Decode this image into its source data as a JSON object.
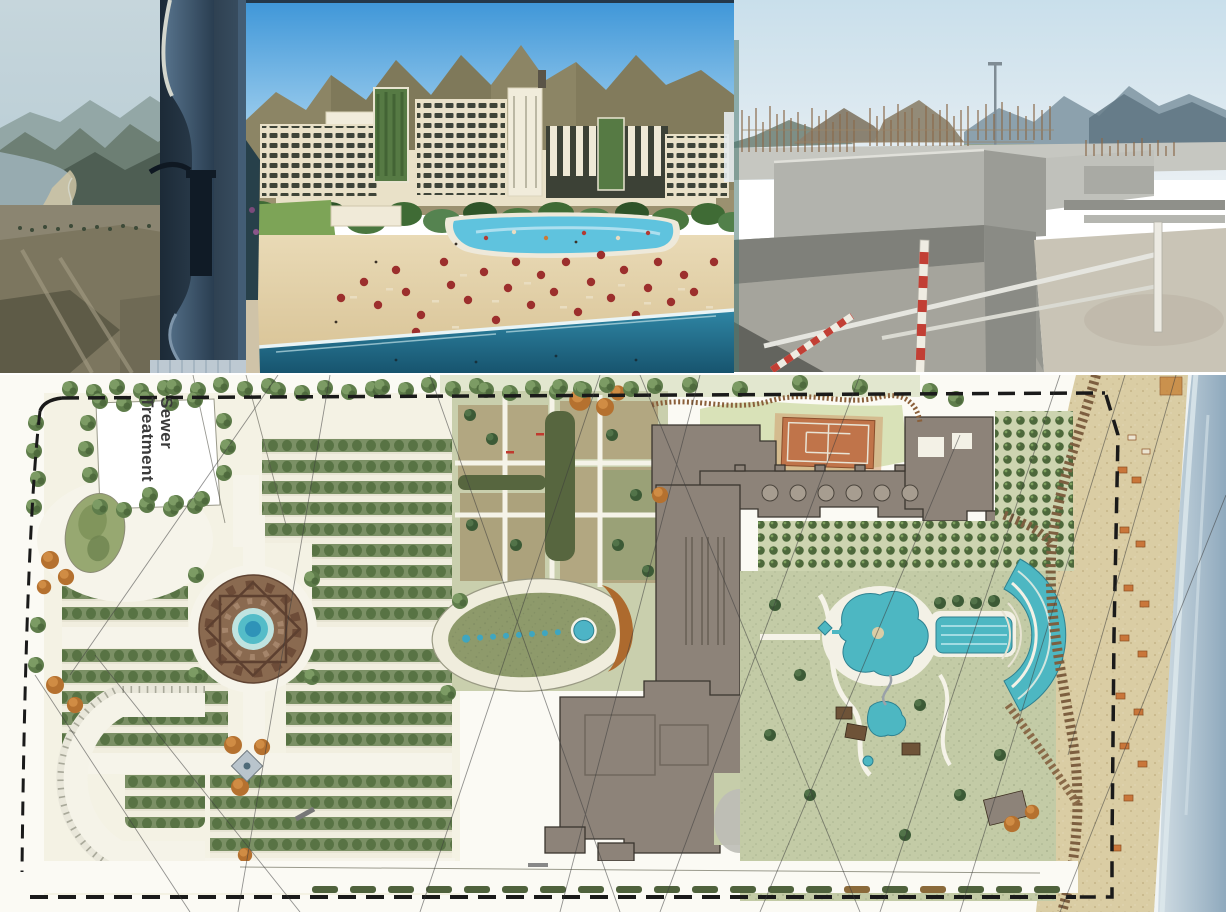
{
  "panels": {
    "coast_photo": {
      "kind": "photograph",
      "subject": "hazy coastal bay with mountains seen past a balcony pillar"
    },
    "resort_render": {
      "kind": "rendering",
      "subject": "beach resort hotel with pools, palms and red beach umbrellas"
    },
    "construction": {
      "kind": "photograph",
      "subject": "concrete foundations with rebar and safety barriers"
    },
    "site_plan": {
      "kind": "master plan drawing",
      "subject": "resort landscape master plan with formal gardens, hotel footprint, pools, boardwalk and beach"
    }
  },
  "site_plan": {
    "labels": {
      "sewer_treatment": "Sewer Treatment"
    }
  },
  "palette": {
    "umbrella_red": "#9c2f2d",
    "pool_turquoise": "#4db7c2",
    "building_taupe": "#8d8379",
    "tennis_clay": "#c0744a",
    "hedge_green": "#5a7347",
    "orange_tree": "#b5712f",
    "sand": "#d9cda6",
    "sea": "#9fb6c9",
    "boardwalk": "#7d5f40",
    "boundary": "#1a1a1a"
  }
}
